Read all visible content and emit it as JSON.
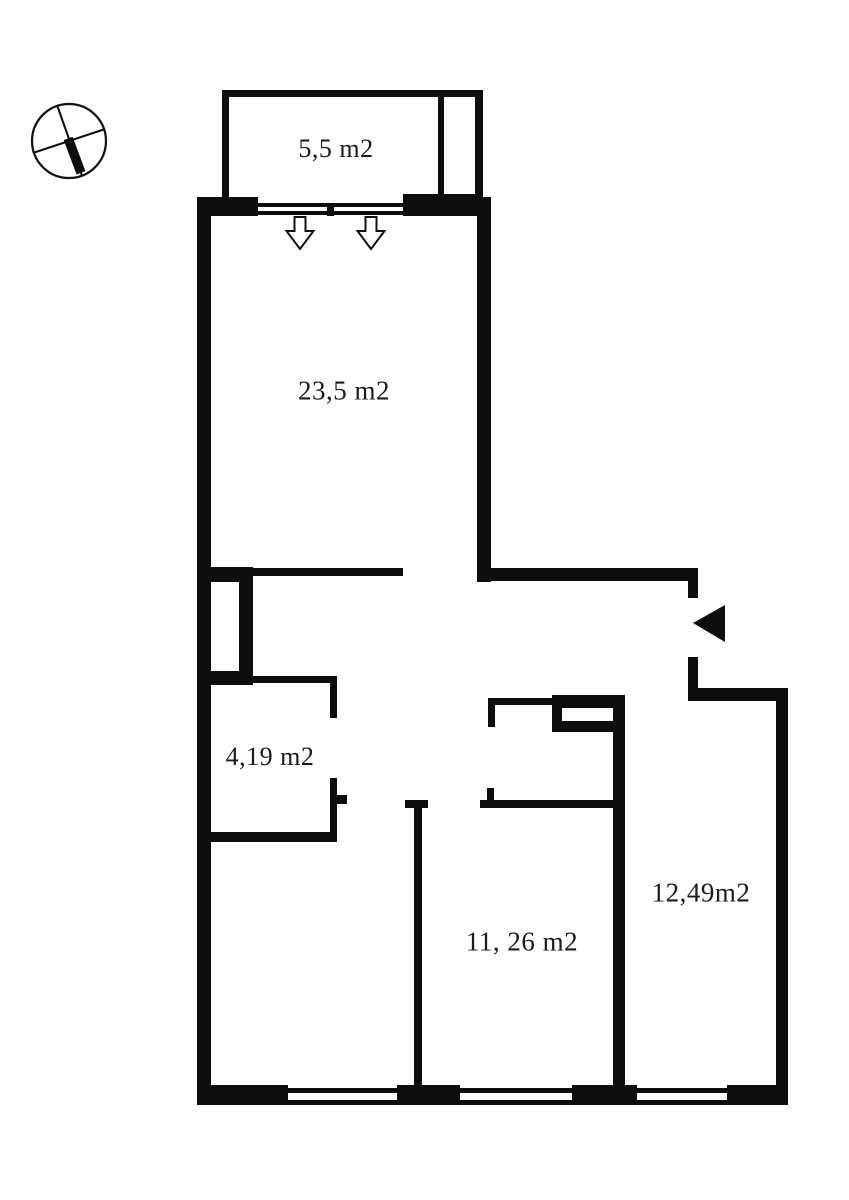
{
  "page": {
    "background_color": "#ffffff",
    "ink_color": "#0d0d0d"
  },
  "plan": {
    "type": "apartment-floor-plan",
    "rooms": [
      {
        "id": "balcony",
        "label": "5,5 m2"
      },
      {
        "id": "living-room",
        "label": "23,5 m2"
      },
      {
        "id": "storage",
        "label": "4,19 m2"
      },
      {
        "id": "bedroom",
        "label": "11, 26 m2"
      },
      {
        "id": "right-room",
        "label": "12,49m2"
      }
    ],
    "markers": {
      "compass": "north-orientation-compass",
      "entrance_arrow": "entrance-direction-triangle-pointing-left",
      "balcony_door_arrows": [
        "down-arrow",
        "down-arrow"
      ]
    }
  }
}
